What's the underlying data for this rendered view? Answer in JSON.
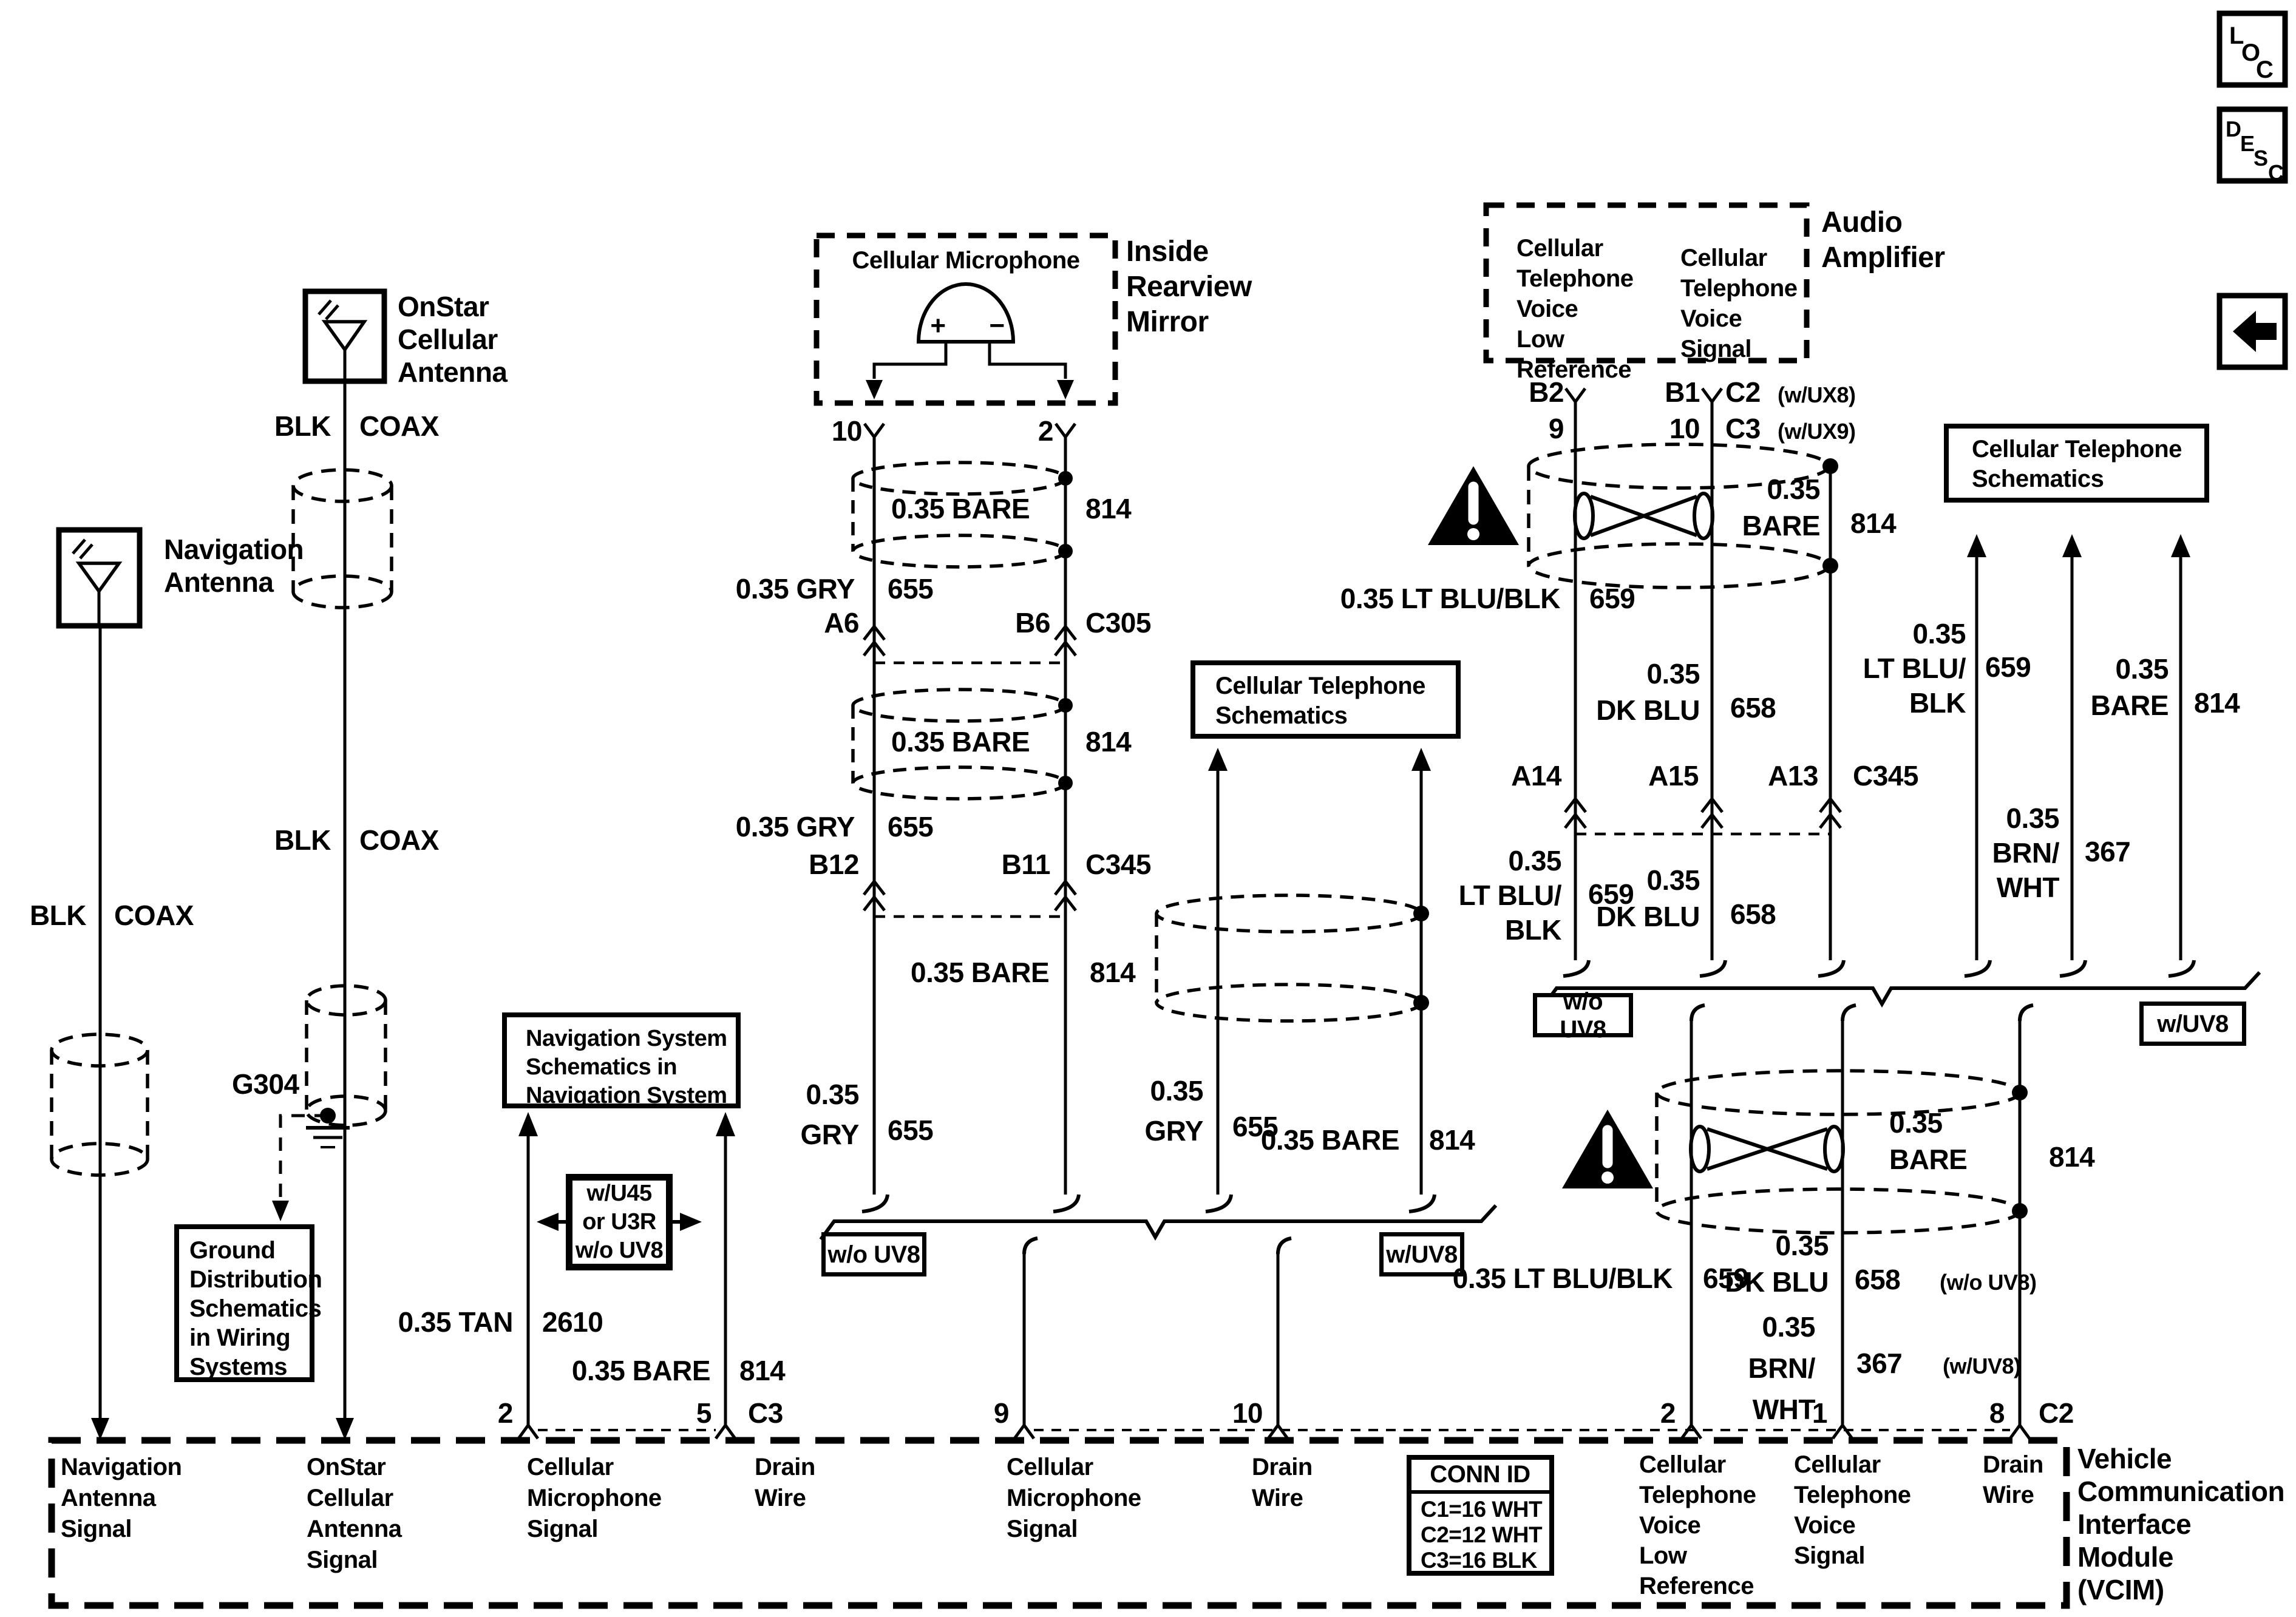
{
  "colors": {
    "ink": "#000000",
    "paper": "#ffffff"
  },
  "corner_icons": {
    "loc": [
      "L",
      "O",
      "C"
    ],
    "desc": [
      "D",
      "E",
      "S",
      "C"
    ],
    "back_arrow": "left-arrow"
  },
  "labels": {
    "onstar_antenna": "OnStar\nCellular\nAntenna",
    "navigation_antenna": "Navigation\nAntenna",
    "blk1": "BLK",
    "coax1": "COAX",
    "blk2": "BLK",
    "coax2": "COAX",
    "blk3": "BLK",
    "coax3": "COAX",
    "g304": "G304",
    "ground_box": "Ground\nDistribution\nSchematics\nin Wiring\nSystems",
    "inside_mirror": "Inside\nRearview\nMirror",
    "cellular_microphone": "Cellular Microphone",
    "mic_plus": "+",
    "mic_minus": "−",
    "pin10_mic": "10",
    "pin2_mic": "2",
    "bare814_1": "0.35 BARE",
    "v814_1": "814",
    "gry655_1": "0.35 GRY",
    "v655_1": "655",
    "a6": "A6",
    "b6": "B6",
    "c305": "C305",
    "bare814_2": "0.35 BARE",
    "v814_2": "814",
    "gry655_2": "0.35 GRY",
    "v655_2": "655",
    "b12": "B12",
    "b11": "B11",
    "c345_mic": "C345",
    "bare814_3": "0.35 BARE",
    "v814_3": "814",
    "gry655_3": "0.35\nGRY",
    "v655_3": "655",
    "gry655_4": "0.35\nGRY",
    "v655_4": "655",
    "bare814_4": "0.35 BARE",
    "v814_4": "814",
    "cts_mid": "Cellular Telephone\nSchematics",
    "cts_right": "Cellular Telephone\nSchematics",
    "audio_amplifier": "Audio\nAmplifier",
    "amp_left_pin": "Cellular\nTelephone\nVoice\nLow\nReference",
    "amp_right_pin": "Cellular\nTelephone\nVoice\nSignal",
    "b2": "B2",
    "pin9_amp": "9",
    "b1": "B1",
    "pin10_amp": "10",
    "c2w": "C2",
    "c2w_p": "(w/UX8)",
    "c3w": "C3",
    "c3w_p": "(w/UX9)",
    "bare_r1": "0.35\nBARE",
    "v814_r1": "814",
    "ltblublk_r1": "0.35 LT BLU/BLK",
    "v659_r1": "659",
    "dkblu_r1": "0.35\nDK BLU",
    "v658_r1": "658",
    "a14": "A14",
    "a15": "A15",
    "a13": "A13",
    "c345_r": "C345",
    "ltblublk_r2": "0.35\nLT BLU/\nBLK",
    "v659_r2": "659",
    "dkblu_r2": "0.35\nDK BLU",
    "v658_r2": "658",
    "ltblublk_r3": "0.35\nLT BLU/\nBLK",
    "v659_r3": "659",
    "bare_r3": "0.35\nBARE",
    "v814_r3": "814",
    "brnwht_r": "0.35\nBRN/\nWHT",
    "v367_r": "367",
    "wo_uv8_1": "w/o UV8",
    "w_uv8_1": "w/UV8",
    "wo_uv8_2": "w/o UV8",
    "w_uv8_2": "w/UV8",
    "bare_l2": "0.35\nBARE",
    "v814_l2": "814",
    "dkblu_l2": "0.35\nDK BLU",
    "v658_l2": "658",
    "wo_uv8_p": "(w/o UV8)",
    "ltblublk_l": "0.35 LT BLU/BLK",
    "v659_l": "659",
    "brnwht_l": "0.35\nBRN/\nWHT",
    "v367_l": "367",
    "w_uv8_p": "(w/UV8)",
    "nav_schem": "Navigation System\nSchematics in\nNavigation System",
    "wu45": "w/U45\nor U3R\nw/o UV8",
    "tan2610": "0.35 TAN",
    "v2610": "2610",
    "bare_nav": "0.35 BARE",
    "v814_nav": "814",
    "pin2_l": "2",
    "pin5": "5",
    "c3_l": "C3",
    "pin9": "9",
    "pin10_l": "10",
    "pin2_r": "2",
    "pin1": "1",
    "pin8": "8",
    "c2_r": "C2",
    "vcim_c1": "Navigation\nAntenna\nSignal",
    "vcim_c2": "OnStar\nCellular\nAntenna\nSignal",
    "vcim_c3": "Cellular\nMicrophone\nSignal",
    "vcim_c4": "Drain\nWire",
    "vcim_c5": "Cellular\nMicrophone\nSignal",
    "vcim_c6": "Drain\nWire",
    "vcim_c7": "Cellular\nTelephone\nVoice\nLow\nReference",
    "vcim_c8": "Cellular\nTelephone\nVoice\nSignal",
    "vcim_c9": "Drain\nWire",
    "vcim_title": "Vehicle\nCommunication\nInterface\nModule\n(VCIM)",
    "conn_id": "CONN ID",
    "conn_c1": "C1=16 WHT",
    "conn_c2": "C2=12 WHT",
    "conn_c3": "C3=16 BLK",
    "loc_l": "L",
    "loc_o": "O",
    "loc_c": "C",
    "desc_d": "D",
    "desc_e": "E",
    "desc_s": "S",
    "desc_c": "C"
  }
}
